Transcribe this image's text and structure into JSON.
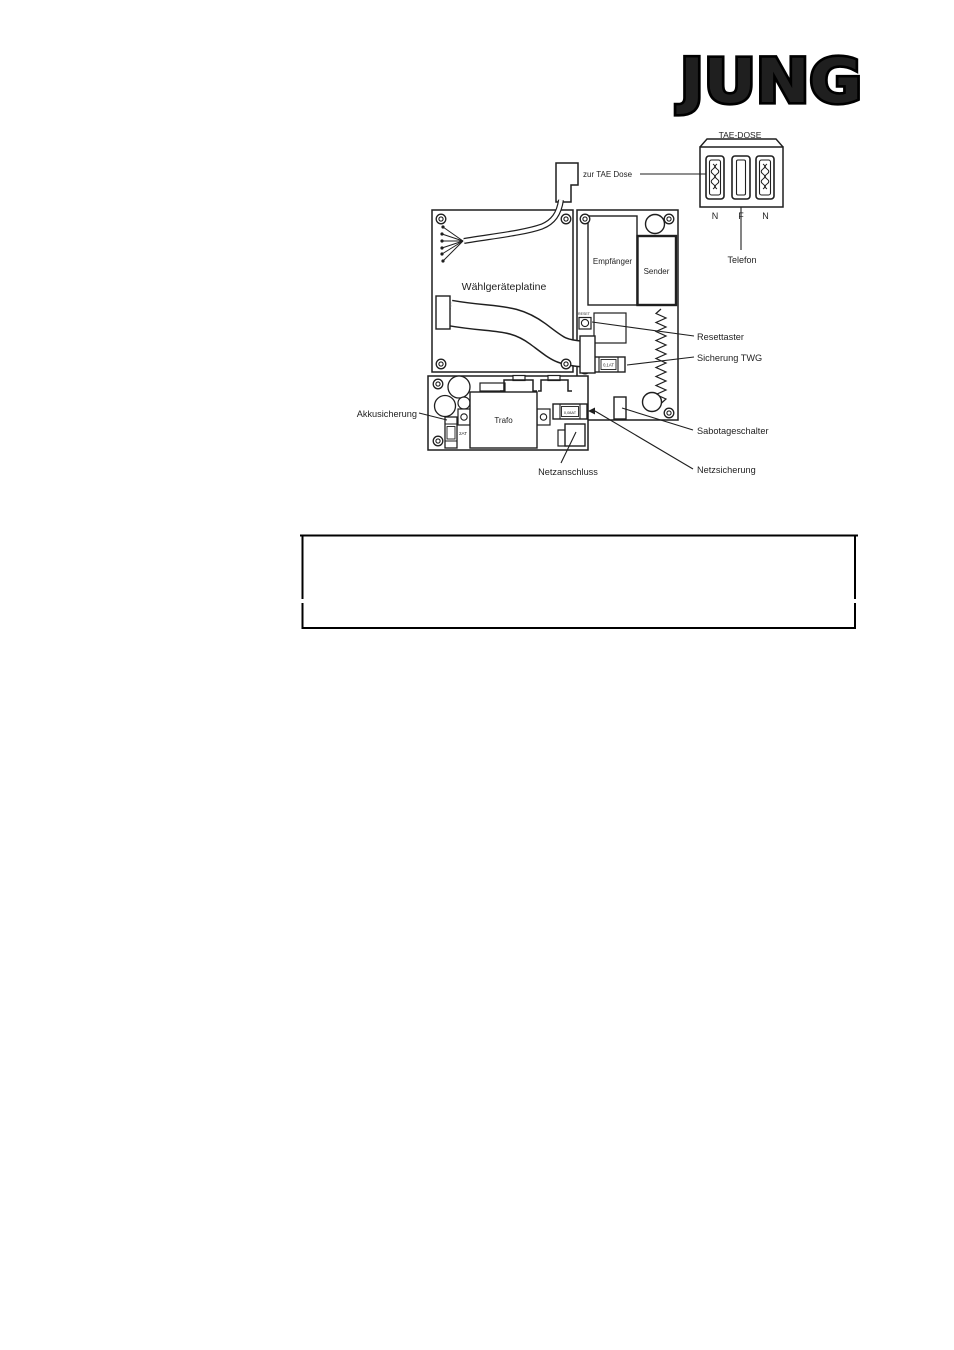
{
  "logo": {
    "text": "JUNG"
  },
  "tae_dose": {
    "title": "TAE-DOSE",
    "slots": [
      "N",
      "F",
      "N"
    ],
    "telefon": "Telefon",
    "zur_tae_dose": "zur TAE Dose"
  },
  "boards": {
    "dialer": "Wählgeräteplatine",
    "receiver": "Empfänger",
    "transmitter": "Sender",
    "transformer": "Trafo",
    "reset_print": "RESET"
  },
  "fuse_values": {
    "twg": "0,1AT",
    "mains": "0,08AT",
    "battery": "2AT"
  },
  "callouts": {
    "reset": "Resettaster",
    "fuse_twg": "Sicherung TWG",
    "tamper": "Sabotageschalter",
    "fuse_mains": "Netzsicherung",
    "mains_connection": "Netzanschluss",
    "fuse_battery": "Akkusicherung"
  },
  "colors": {
    "ink": "#1f1f1f",
    "paper": "#ffffff"
  }
}
